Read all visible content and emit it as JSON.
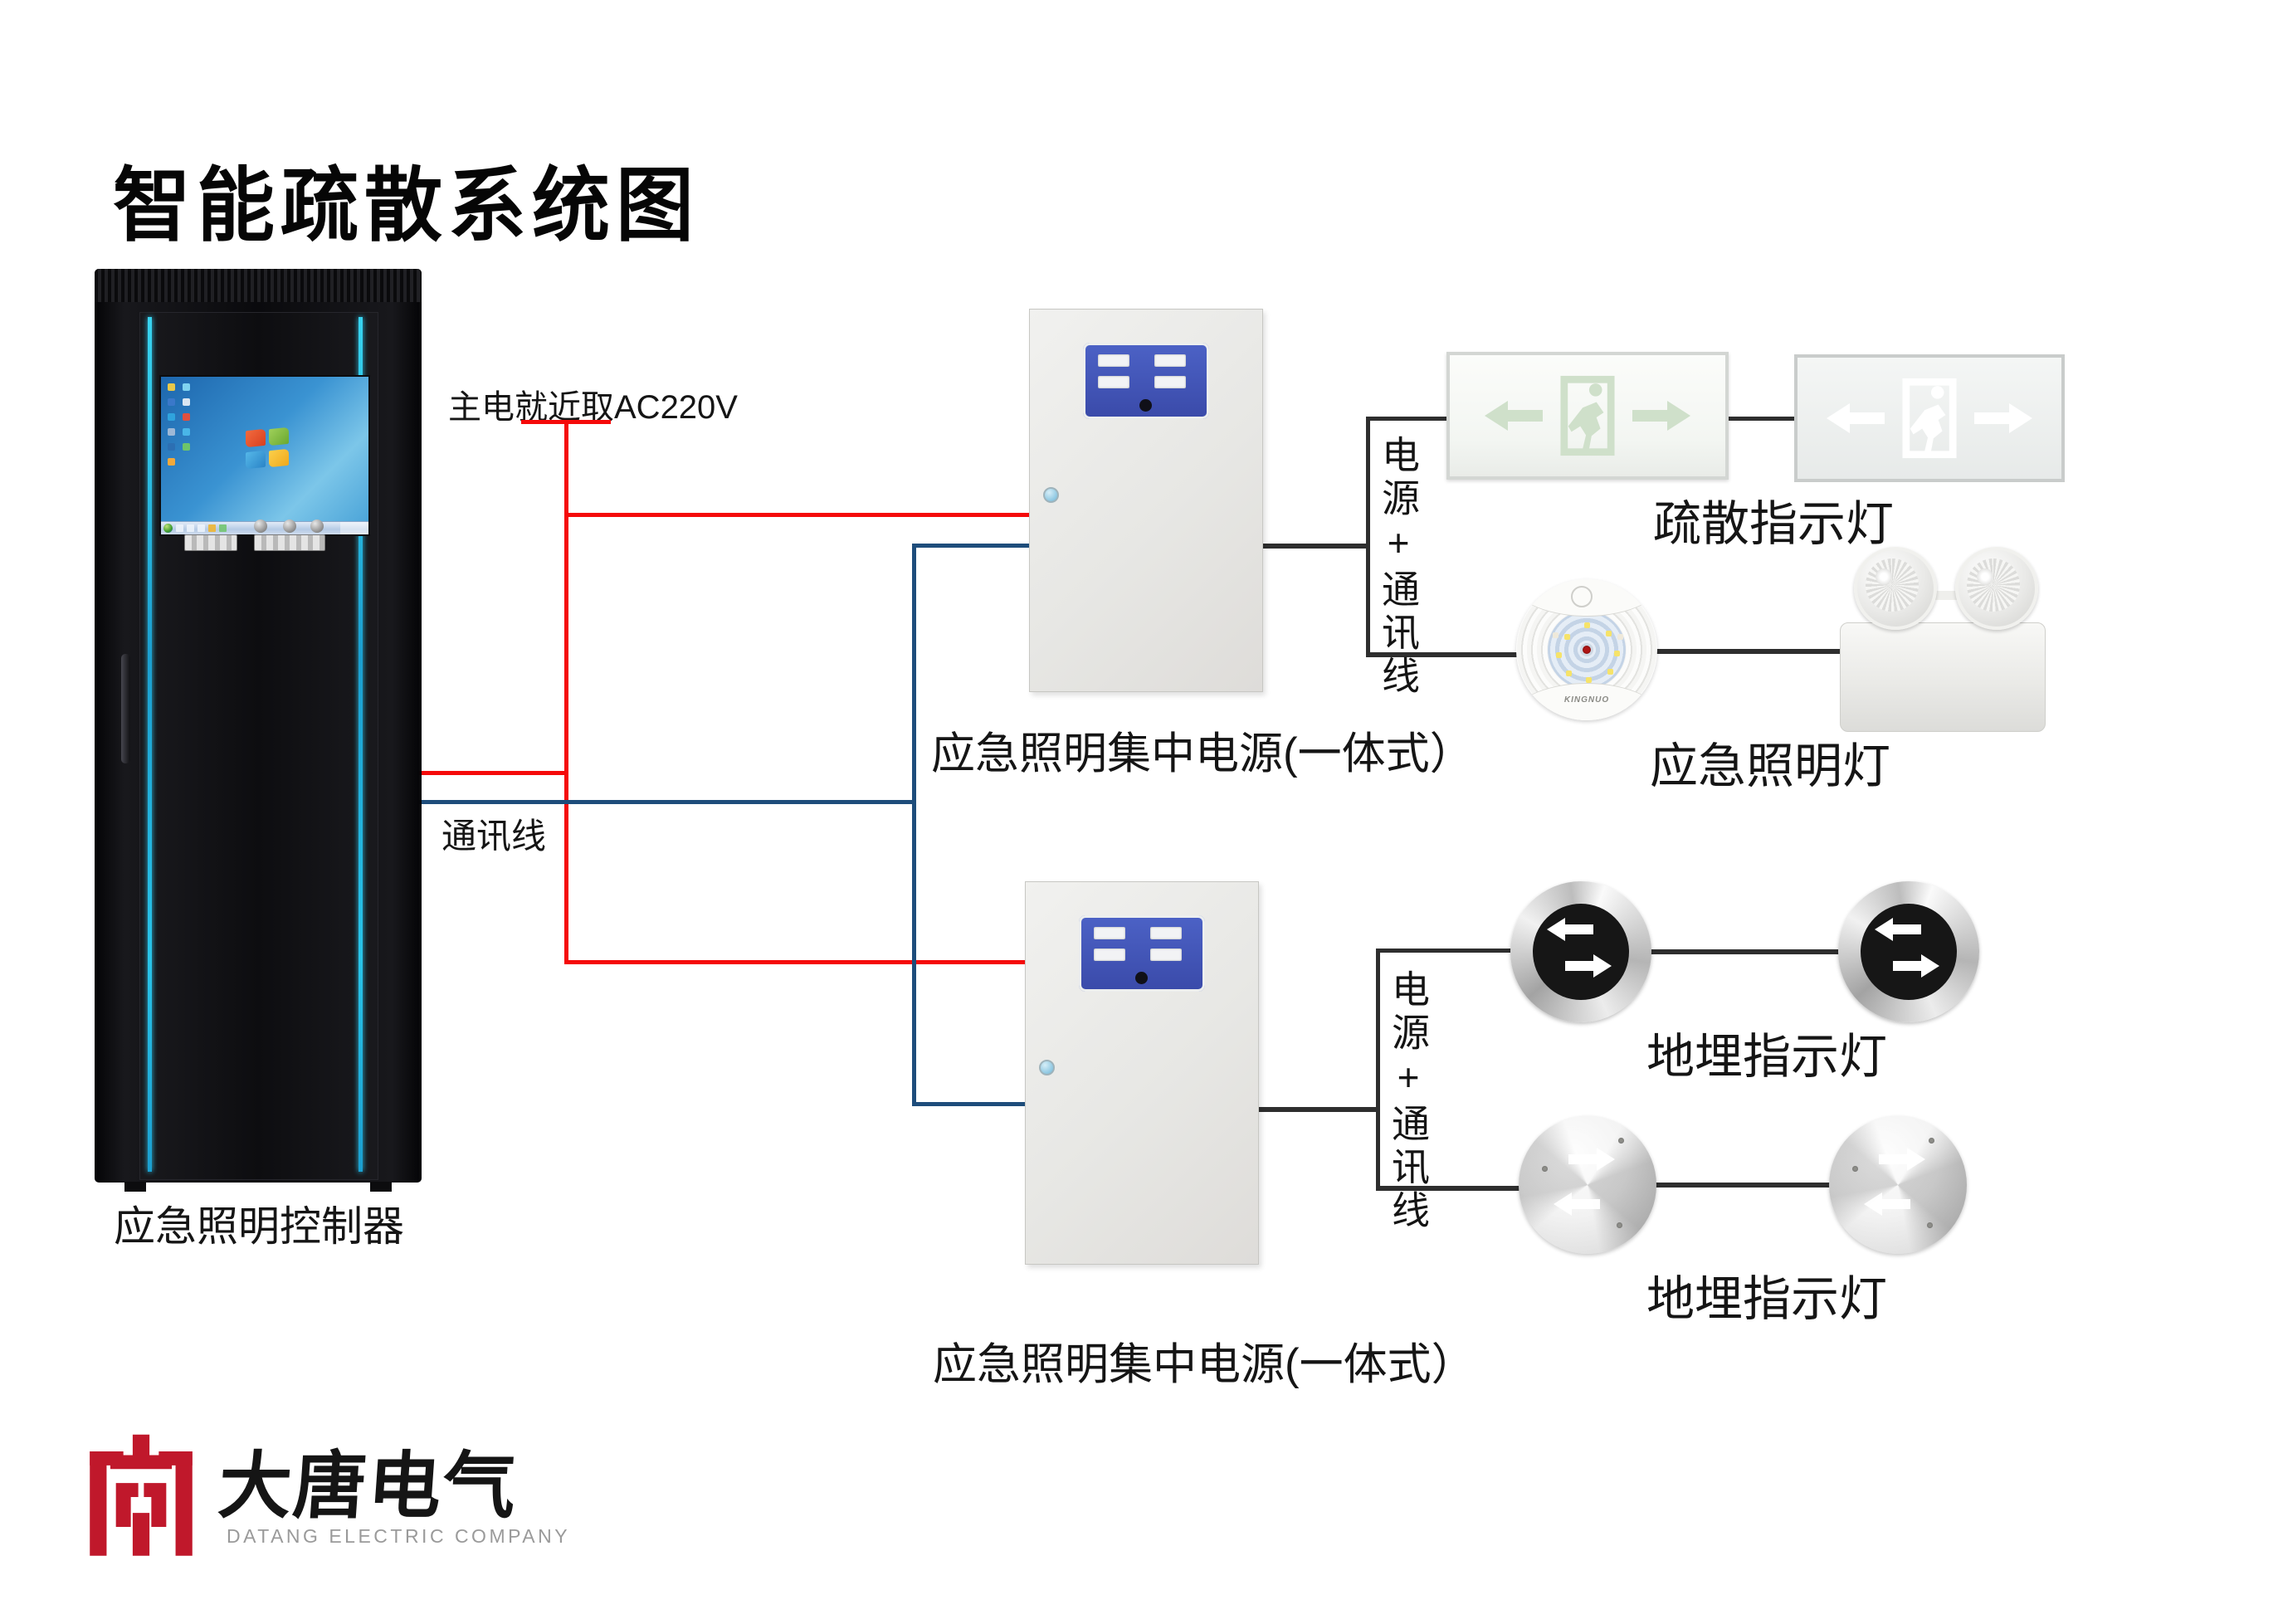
{
  "title": "智能疏散系统图",
  "colors": {
    "wire_power": "#f50a0a",
    "wire_comm": "#1e4d7b",
    "wire_black": "#2e2e2e",
    "panel_blue": "#4156b8",
    "logo_red": "#c0182b",
    "pictogram_green": "#cfe0ca"
  },
  "controller": {
    "label": "应急照明控制器"
  },
  "wires": {
    "main_power_label": "主电就近取AC220V",
    "comm_label": "通讯线"
  },
  "group1": {
    "power_box_label": "应急照明集中电源(一体式）",
    "bundle_label": "电源+通讯线",
    "exit_sign_label": "疏散指示灯",
    "emergency_light_label": "应急照明灯",
    "lamp_brand": "KINGNUO"
  },
  "group2": {
    "power_box_label": "应急照明集中电源(一体式）",
    "bundle_label": "电源+通讯线",
    "buried_light_label_1": "地埋指示灯",
    "buried_light_label_2": "地埋指示灯"
  },
  "logo": {
    "name_cn": "大唐电气",
    "name_en": "DATANG ELECTRIC COMPANY"
  }
}
